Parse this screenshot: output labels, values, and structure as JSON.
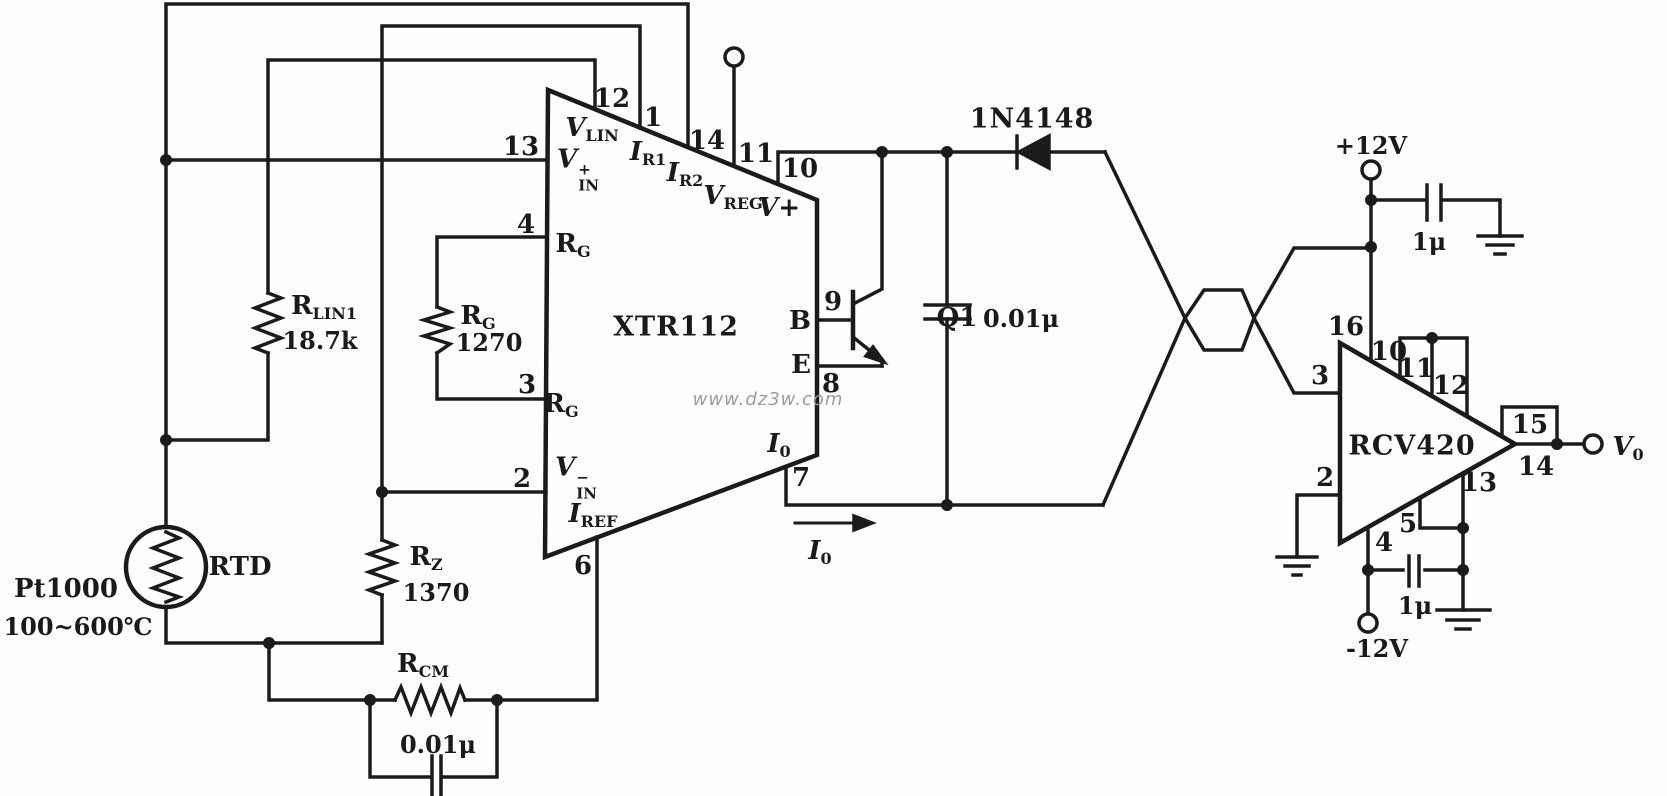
{
  "watermark": "www.dz3w.com",
  "power": {
    "vpos": "+12V",
    "vneg": "-12V"
  },
  "output_v": {
    "sym": "V",
    "sub": "0"
  },
  "loop_current": {
    "sym": "I",
    "sub": "0"
  },
  "components": {
    "rtd": {
      "label": "RTD",
      "part": "Pt1000",
      "range": "100~600℃"
    },
    "r_lin1": {
      "sym": "R",
      "sub": "LIN1",
      "value": "18.7k"
    },
    "r_g": {
      "sym": "R",
      "sub": "G",
      "value": "1270"
    },
    "r_z": {
      "sym": "R",
      "sub": "Z",
      "value": "1370"
    },
    "r_cm": {
      "sym": "R",
      "sub": "CM"
    },
    "c_cm": {
      "value": "0.01μ"
    },
    "c_loop": {
      "value": "0.01μ"
    },
    "c_vpos": {
      "value": "1μ"
    },
    "c_vneg": {
      "value": "1μ"
    },
    "d1": {
      "part": "1N4148"
    },
    "q1": {
      "label": "Q1"
    },
    "xtr": {
      "part": "XTR112"
    },
    "rcv": {
      "part": "RCV420"
    }
  },
  "xtr_pins": {
    "p13": "13",
    "p12": "12",
    "p1": "1",
    "p14": "14",
    "p11": "11",
    "p10": "10",
    "p4": "4",
    "p3": "3",
    "p2": "2",
    "p6": "6",
    "p7": "7",
    "p9": "9",
    "p8": "8",
    "vin_p": {
      "sym": "V",
      "sup": "+",
      "sub": "IN"
    },
    "vin_n": {
      "sym": "V",
      "sup": "−",
      "sub": "IN"
    },
    "vlin": {
      "sym": "V",
      "sub": "LIN"
    },
    "ir1": {
      "sym": "I",
      "sub": "R1"
    },
    "ir2": {
      "sym": "I",
      "sub": "R2"
    },
    "vreg": {
      "sym": "V",
      "sub": "REG"
    },
    "vplus": "V+",
    "rg_upper": {
      "sym": "R",
      "sub": "G"
    },
    "rg_lower": {
      "sym": "R",
      "sub": "G"
    },
    "iref": {
      "sym": "I",
      "sub": "REF"
    },
    "io": {
      "sym": "I",
      "sub": "0"
    },
    "b": "B",
    "e": "E"
  },
  "rcv_pins": {
    "p16": "16",
    "p10": "10",
    "p11": "11",
    "p12": "12",
    "p3": "3",
    "p2": "2",
    "p4": "4",
    "p5": "5",
    "p13": "13",
    "p15": "15",
    "p14": "14"
  }
}
